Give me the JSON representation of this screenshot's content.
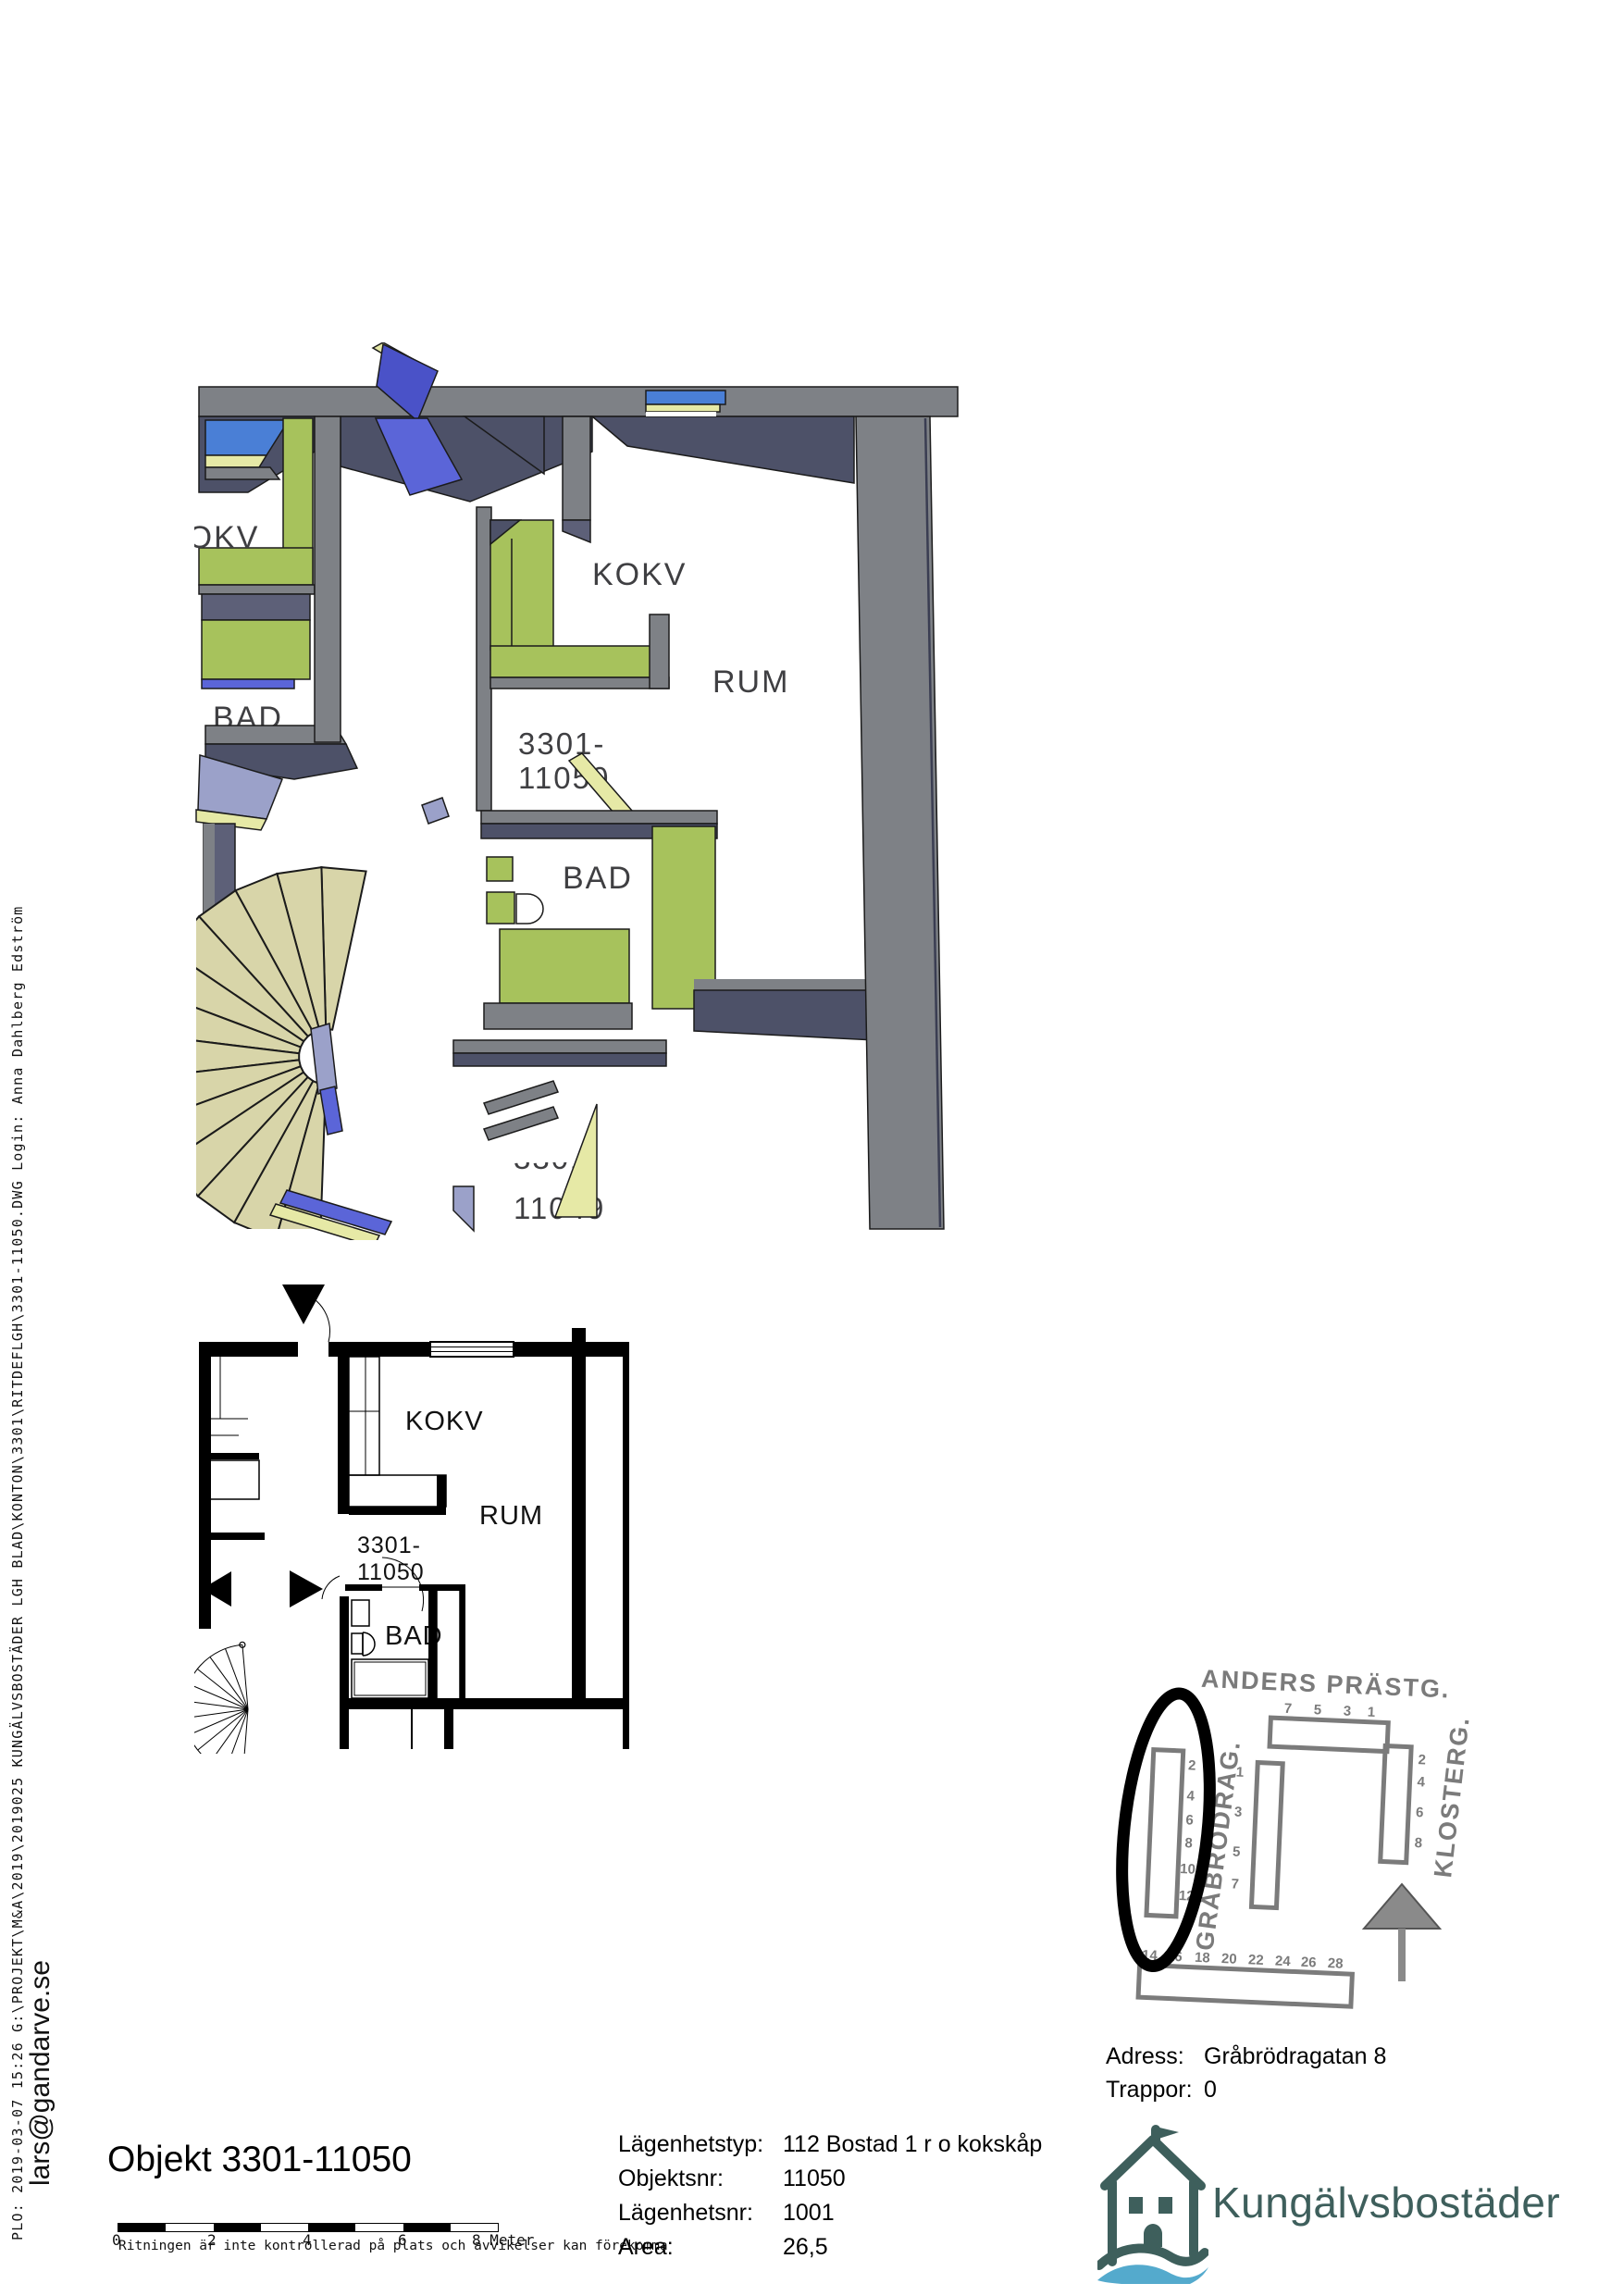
{
  "sidebar": {
    "plot_info": "PLO:  2019-03-07  15:26    G:\\PROJEKT\\M&A\\2019\\2019025 KUNGÄLVSBOSTÄDER LGH BLAD\\KONTON\\3301\\RITDEFLGH\\3301-11050.DWG Login: Anna Dahlberg Edström",
    "email": "lars@gandarve.se"
  },
  "plan3d": {
    "labels": {
      "kokv_left": "KOKV",
      "bad_left": "BAD",
      "kokv": "KOKV",
      "rum": "RUM",
      "bad": "BAD",
      "apt_top": "3301-",
      "apt_bottom": "11050",
      "neighbor_top": "3301-",
      "neighbor_bottom": "11049"
    }
  },
  "plan2d": {
    "labels": {
      "kokv": "KOKV",
      "rum": "RUM",
      "bad": "BAD",
      "apt_top": "3301-",
      "apt_bottom": "11050"
    }
  },
  "sitemap": {
    "streets": {
      "top": "ANDERS PRÄSTG.",
      "right": "KLOSTERG.",
      "left": "GRÅBRÖDRAG."
    },
    "top_numbers": [
      "7",
      "5",
      "3",
      "1"
    ],
    "right_numbers": [
      "2",
      "4",
      "6",
      "8"
    ],
    "middle_numbers": [
      "1",
      "3",
      "5",
      "7"
    ],
    "left_numbers": [
      "2",
      "4",
      "6",
      "8",
      "10",
      "12"
    ],
    "bottom_numbers": [
      "14",
      "16",
      "18",
      "20",
      "22",
      "24",
      "26",
      "28"
    ]
  },
  "address": {
    "label": "Adress:",
    "value": "Gråbrödragatan 8",
    "floor_label": "Trappor:",
    "floor_value": "0"
  },
  "title": "Objekt 3301-11050",
  "details": {
    "rows": [
      {
        "label": "Lägenhetstyp:",
        "value": "112 Bostad 1 r o kokskåp"
      },
      {
        "label": "Objektsnr:",
        "value": "11050"
      },
      {
        "label": "Lägenhetsnr:",
        "value": "1001"
      },
      {
        "label": "Area:",
        "value": "26,5"
      }
    ]
  },
  "scalebar": {
    "ticks": [
      "0",
      "2",
      "4",
      "6",
      "8 Meter"
    ],
    "disclaimer": "Ritningen är inte kontrollerad på plats och avvikelser kan förekomma"
  },
  "logo": {
    "text": "Kungälvsbostäder"
  },
  "colors": {
    "wall_gray": "#7e8186",
    "wall_dark": "#4d5168",
    "cabinet_green": "#a7c25c",
    "window_blue": "#4a7fd6",
    "door_blue": "#4a52c8",
    "pale_yellow": "#e6e9a6",
    "stair_beige": "#d8d5a9",
    "lavender": "#9ba1c9",
    "map_gray": "#7b7b7b",
    "logo_teal": "#3e5f5c",
    "logo_blue": "#54aacd"
  }
}
